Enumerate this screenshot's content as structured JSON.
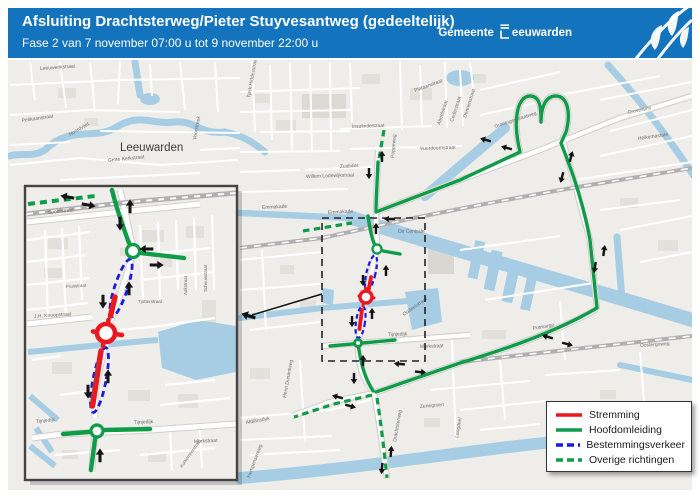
{
  "header": {
    "title": "Afsluiting Drachtsterweg/Pieter Stuyvesantweg (gedeeltelijk)",
    "subtitle": "Fase 2 van 7 november 07:00 u tot 9 november 22:00 u",
    "logo": {
      "word1": "Gemeente",
      "word2": "eeuwarden"
    }
  },
  "colors": {
    "header_blue": "#1373bd",
    "water": "#a6cde4",
    "stremming_red": "#e8191f",
    "omleiding_green": "#0f9b48",
    "bestemming_blue": "#1a1ae0",
    "railway_gray": "#b0b0b0"
  },
  "legend": {
    "items": [
      {
        "label": "Stremming",
        "color": "#e8191f",
        "dashed": false
      },
      {
        "label": "Hoofdomleiding",
        "color": "#0f9b48",
        "dashed": false
      },
      {
        "label": "Bestemmingsverkeer",
        "color": "#1a1ae0",
        "dashed": true
      },
      {
        "label": "Overige richtingen",
        "color": "#0f9b48",
        "dashed": true
      }
    ]
  },
  "map": {
    "labels": [
      {
        "t": "Leeuwarden",
        "x": 120,
        "y": 151,
        "s": 11.5,
        "c": "#3b3b3b"
      },
      {
        "t": "Leeuwerikstraat",
        "x": 40,
        "y": 70,
        "r": -4
      },
      {
        "t": "Pelikaanstraat",
        "x": 22,
        "y": 122,
        "r": -8
      },
      {
        "t": "Noordvliet",
        "x": 70,
        "y": 136,
        "r": -30
      },
      {
        "t": "Grote Kerkstraat",
        "x": 108,
        "y": 162,
        "r": -6
      },
      {
        "t": "Voorstreek",
        "x": 196,
        "y": 140,
        "r": -80
      },
      {
        "t": "Tjerk Hiddesstraat",
        "x": 250,
        "y": 98,
        "r": -80
      },
      {
        "t": "Emmakade",
        "x": 262,
        "y": 209,
        "r": -3
      },
      {
        "t": "Emmakade",
        "x": 328,
        "y": 214,
        "r": -3
      },
      {
        "t": "Zuidvliet",
        "x": 340,
        "y": 168,
        "r": -3
      },
      {
        "t": "Insulindestraat",
        "x": 352,
        "y": 128,
        "r": -2
      },
      {
        "t": "Willem Lodewijkstraat",
        "x": 306,
        "y": 178,
        "r": -2
      },
      {
        "t": "De Centrale",
        "x": 398,
        "y": 233
      },
      {
        "t": "Poppeweg",
        "x": 394,
        "y": 158,
        "r": -85
      },
      {
        "t": "Vuurdoornstraat",
        "x": 420,
        "y": 150,
        "r": -2
      },
      {
        "t": "Plataanstraat",
        "x": 415,
        "y": 92,
        "r": -20
      },
      {
        "t": "Abeelstraat",
        "x": 440,
        "y": 125,
        "r": -72
      },
      {
        "t": "Cederstraat",
        "x": 453,
        "y": 122,
        "r": -72
      },
      {
        "t": "Dennenstraat",
        "x": 466,
        "y": 118,
        "r": -72
      },
      {
        "t": "Groningerstraatweg",
        "x": 495,
        "y": 128,
        "r": -18
      },
      {
        "t": "Grovestins",
        "x": 628,
        "y": 114,
        "r": -12
      },
      {
        "t": "Heikemastate",
        "x": 638,
        "y": 140,
        "r": -8
      },
      {
        "t": "Tijnjedijk",
        "x": 388,
        "y": 336,
        "r": -2
      },
      {
        "t": "Murkstraat",
        "x": 420,
        "y": 348,
        "r": -2
      },
      {
        "t": "Oudeelstraat",
        "x": 404,
        "y": 316,
        "r": -35
      },
      {
        "t": "Potmarge",
        "x": 533,
        "y": 330,
        "r": -10
      },
      {
        "t": "Oostergoweg",
        "x": 640,
        "y": 347,
        "r": -4
      },
      {
        "t": "Aldlânsdyk",
        "x": 246,
        "y": 424,
        "r": -10
      },
      {
        "t": "Henri Dunantweg",
        "x": 286,
        "y": 398,
        "r": -80
      },
      {
        "t": "Drachtsterweg",
        "x": 396,
        "y": 442,
        "r": -80
      },
      {
        "t": "Zenegroen",
        "x": 420,
        "y": 408,
        "r": -5
      },
      {
        "t": "Langdeel",
        "x": 458,
        "y": 438,
        "r": -80
      },
      {
        "t": "Hempenserweg",
        "x": 250,
        "y": 478,
        "r": -70
      }
    ],
    "arrows": [
      {
        "x": 382,
        "y": 157,
        "a": 270
      },
      {
        "x": 369,
        "y": 173,
        "a": 90
      },
      {
        "x": 486,
        "y": 140,
        "a": 195
      },
      {
        "x": 507,
        "y": 148,
        "a": 195
      },
      {
        "x": 571,
        "y": 157,
        "a": 285
      },
      {
        "x": 562,
        "y": 177,
        "a": 105
      },
      {
        "x": 604,
        "y": 251,
        "a": 278
      },
      {
        "x": 595,
        "y": 267,
        "a": 98
      },
      {
        "x": 548,
        "y": 337,
        "a": 195
      },
      {
        "x": 567,
        "y": 344,
        "a": 15
      },
      {
        "x": 400,
        "y": 364,
        "a": 185
      },
      {
        "x": 420,
        "y": 372,
        "a": 5
      },
      {
        "x": 363,
        "y": 361,
        "a": 270
      },
      {
        "x": 354,
        "y": 378,
        "a": 90
      },
      {
        "x": 338,
        "y": 397,
        "a": 195
      },
      {
        "x": 350,
        "y": 406,
        "a": 15
      },
      {
        "x": 391,
        "y": 452,
        "a": 275
      },
      {
        "x": 382,
        "y": 468,
        "a": 95
      },
      {
        "x": 390,
        "y": 219,
        "a": 180
      },
      {
        "x": 376,
        "y": 229,
        "a": 270
      },
      {
        "x": 386,
        "y": 271,
        "a": 270
      },
      {
        "x": 363,
        "y": 280,
        "a": 90
      },
      {
        "x": 372,
        "y": 314,
        "a": 270
      },
      {
        "x": 352,
        "y": 321,
        "a": 90
      }
    ]
  },
  "inset": {
    "labels": [
      {
        "t": "Spoorstraat",
        "x": 48,
        "y": 214,
        "r": -6
      },
      {
        "t": "J.H. Knoopstraat",
        "x": 34,
        "y": 318,
        "r": -4
      },
      {
        "t": "Fruitstraat",
        "x": 66,
        "y": 288,
        "r": -4,
        "s": 4.5
      },
      {
        "t": "Tjotterstraat",
        "x": 138,
        "y": 303,
        "s": 4.5
      },
      {
        "t": "Aakstraat",
        "x": 187,
        "y": 295,
        "r": -90,
        "s": 4.5
      },
      {
        "t": "Schouwstraat",
        "x": 207,
        "y": 292,
        "r": -90,
        "s": 4.5
      },
      {
        "t": "Tijnjedijk",
        "x": 36,
        "y": 423,
        "r": -6
      },
      {
        "t": "Tijnjedijk",
        "x": 134,
        "y": 424,
        "r": -3
      },
      {
        "t": "Murkstraat",
        "x": 194,
        "y": 443,
        "r": -3
      },
      {
        "t": "Kurkemeerstraat",
        "x": 182,
        "y": 468,
        "r": -55,
        "s": 4.5
      },
      {
        "t": "Pieter Stuyvesantweg",
        "x": 92,
        "y": 402,
        "r": -80,
        "s": 4.3,
        "c": "#8a5a52"
      }
    ],
    "arrows": [
      {
        "x": 68,
        "y": 197,
        "a": 190
      },
      {
        "x": 88,
        "y": 205,
        "a": 10
      },
      {
        "x": 130,
        "y": 207,
        "a": 270
      },
      {
        "x": 120,
        "y": 223,
        "a": 90
      },
      {
        "x": 147,
        "y": 249,
        "a": 180
      },
      {
        "x": 156,
        "y": 265,
        "a": 0
      },
      {
        "x": 129,
        "y": 289,
        "a": 270
      },
      {
        "x": 103,
        "y": 301,
        "a": 90
      },
      {
        "x": 108,
        "y": 377,
        "a": 270
      },
      {
        "x": 88,
        "y": 391,
        "a": 90
      },
      {
        "x": 100,
        "y": 456,
        "a": 270
      }
    ]
  }
}
